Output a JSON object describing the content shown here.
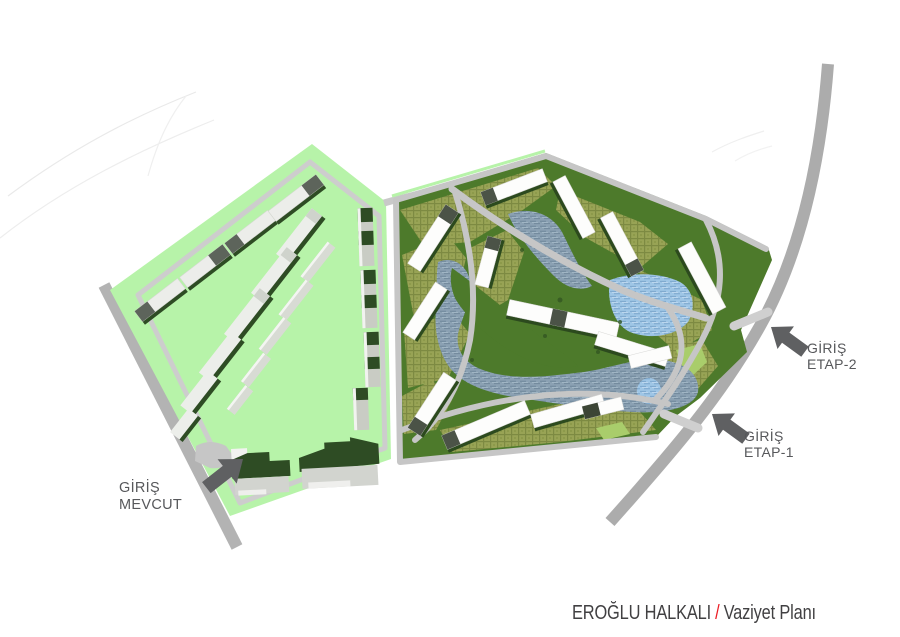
{
  "title": {
    "project": "EROĞLU HALKALI",
    "separator": "/",
    "subtitle": "Vaziyet Planı"
  },
  "annotations": {
    "entrance_existing": {
      "line1": "GİRİŞ",
      "line2": "MEVCUT",
      "arrow_direction": "northeast"
    },
    "entrance_etap_1": {
      "line1": "GİRİŞ",
      "line2": "ETAP-1",
      "arrow_direction": "northwest"
    },
    "entrance_etap_2": {
      "line1": "GİRİŞ",
      "line2": "ETAP-2",
      "arrow_direction": "northwest"
    }
  },
  "areas": {
    "existing_site": "MEVCUT (pale green housing parcel, west)",
    "proposed_site": "ETAP-1 / ETAP-2 (dark green masterplan parcel, east)"
  },
  "colors": {
    "existing_site_green": "#b7f3a9",
    "proposed_site_green": "#4d7a2b",
    "paved_garden_khaki": "#98a355",
    "water_gray": "#8ba1b3",
    "water_blue": "#9fc6e6",
    "road_gray": "#acacac",
    "inner_road_gray": "#c6c6c6",
    "building_white": "#fdfdfc",
    "roof_dark_green": "#2e4c24",
    "roof_dark_gray": "#4b5347",
    "arrow_gray": "#5f6062",
    "label_gray": "#57585b",
    "title_text": "#414042",
    "title_accent_red": "#ec1c24",
    "background": "#ffffff"
  }
}
